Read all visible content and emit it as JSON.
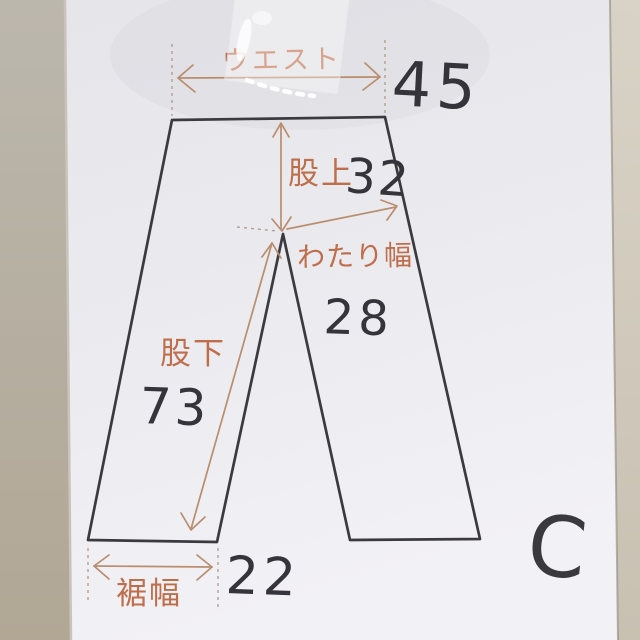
{
  "diagram": {
    "type": "pants-measurement-sketch",
    "measurements": {
      "waist": {
        "label": "ウエスト",
        "value": "45"
      },
      "rise": {
        "label": "股上",
        "value": "32"
      },
      "thigh_width": {
        "label": "わたり幅",
        "value": "28"
      },
      "inseam": {
        "label": "股下",
        "value": "73"
      },
      "hem_width": {
        "label": "裾幅",
        "value": "22"
      }
    },
    "annotation": {
      "mark": "C"
    }
  },
  "colors": {
    "paper": "#ebeaef",
    "background_left": "#b5ac9d",
    "background_right": "#cfc8ba",
    "outline_ink": "#3b3a3e",
    "marker_text": "#bf6e4b",
    "measure_line": "#b98d6d",
    "number_ink": "#35343a"
  }
}
